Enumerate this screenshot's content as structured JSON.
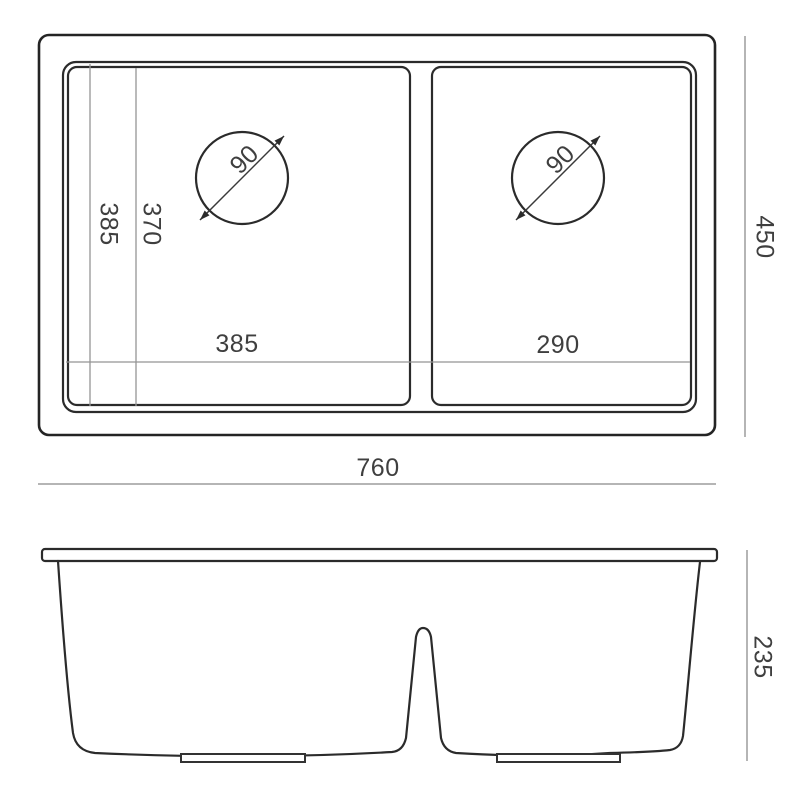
{
  "colors": {
    "background": "#ffffff",
    "object_line": "#2b2b2b",
    "inner_dimension_line": "#949494",
    "outer_dimension_line": "#b5b5b5",
    "label_text": "#3f3f3f"
  },
  "top_view": {
    "overall_width_label": "760",
    "overall_depth_label": "450",
    "vertical_dim_labels": {
      "first": "385",
      "second": "370"
    },
    "left_bowl_width_label": "385",
    "right_bowl_width_label": "290",
    "left_drain_label": "90",
    "right_drain_label": "90"
  },
  "front_view": {
    "height_label": "235"
  }
}
